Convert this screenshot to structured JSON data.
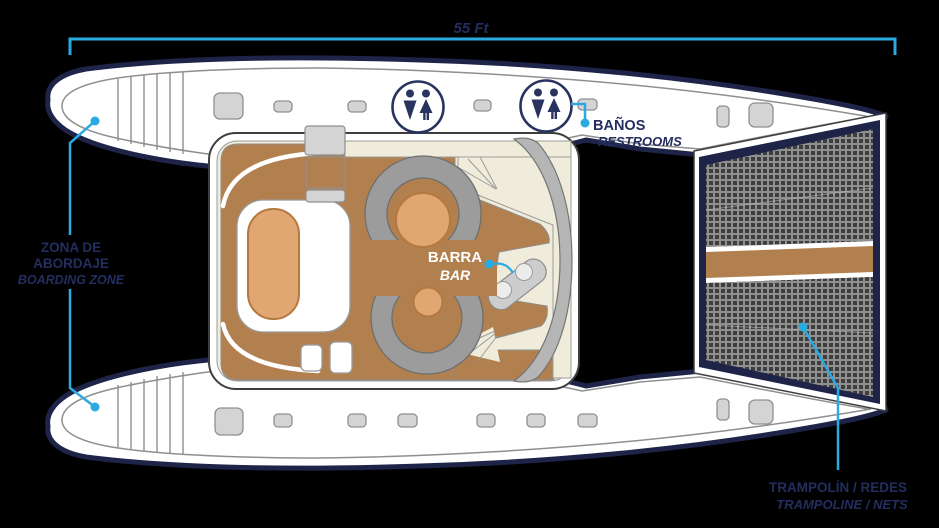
{
  "dimension": {
    "length_label": "55 Ft"
  },
  "zones": {
    "boarding": {
      "es_line1": "ZONA DE",
      "es_line2": "ABORDAJE",
      "en": "BOARDING ZONE"
    },
    "restrooms": {
      "es": "BAÑOS",
      "en": "RESTROOMS"
    },
    "bar": {
      "es": "BARRA",
      "en": "BAR"
    },
    "trampoline": {
      "es": "TRAMPOLÍN / REDES",
      "en": "TRAMPOLINE / NETS"
    }
  },
  "icons": {
    "restroom": "mens-womens-restroom-icon"
  },
  "colors": {
    "background": "#000000",
    "accent_cyan": "#29abe2",
    "hull_navy": "#1e2448",
    "text_navy": "#232e5f",
    "deck_brown": "#b2804f",
    "cushion_tan": "#e0a772",
    "cream": "#f0ecdb",
    "seat_gray": "#9c9c9c",
    "hull_white": "#ffffff"
  }
}
